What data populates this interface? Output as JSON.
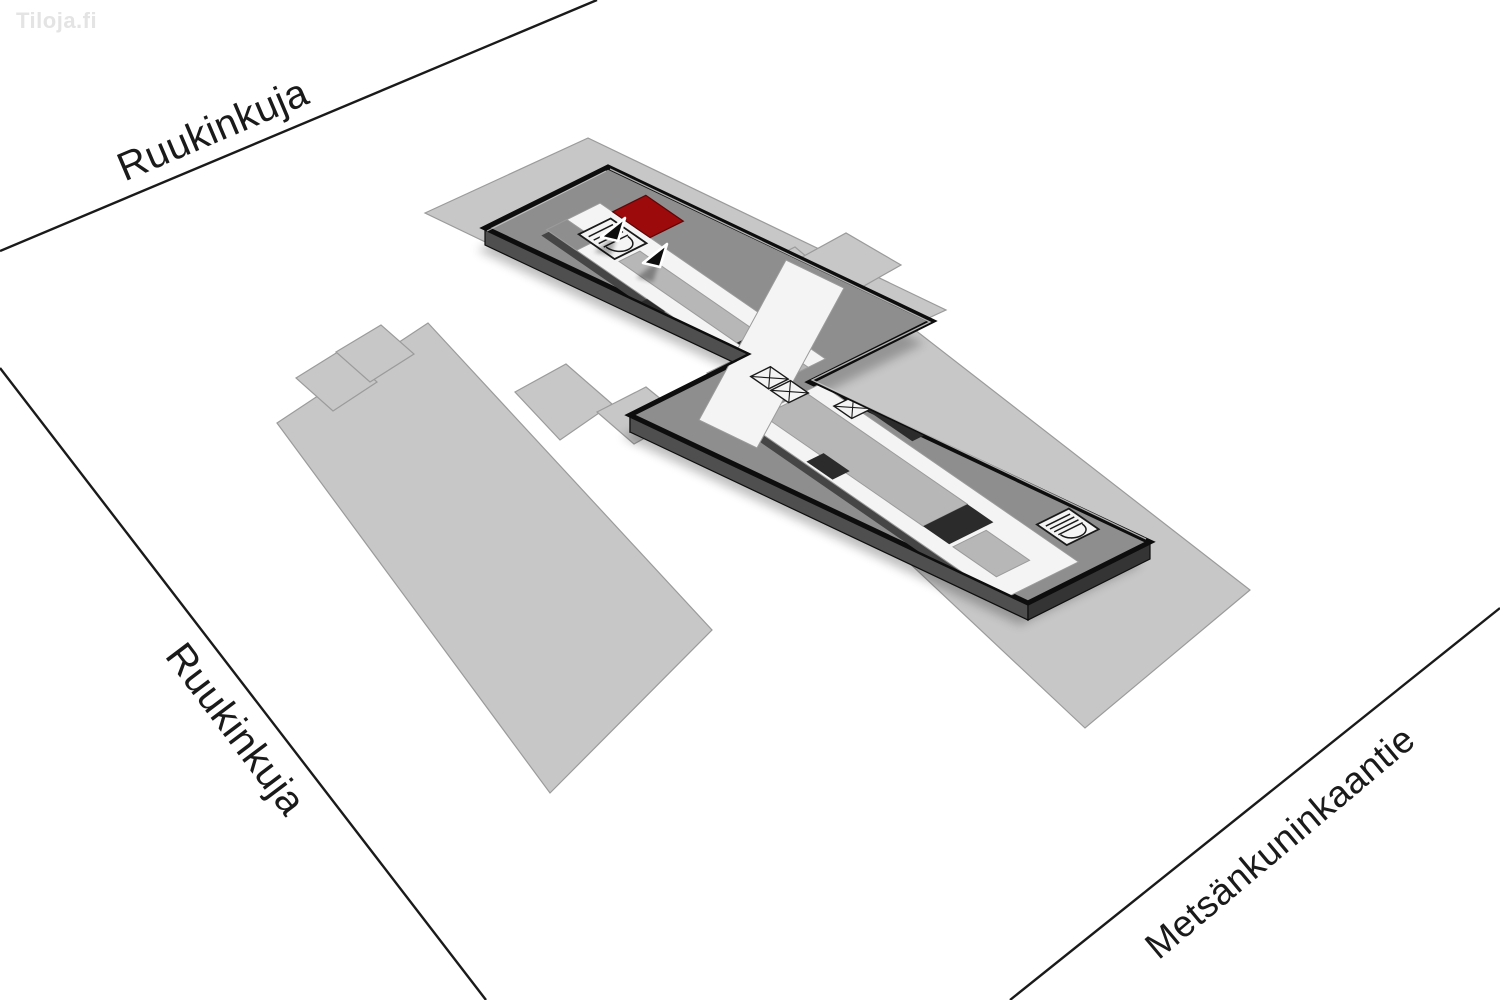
{
  "watermark": {
    "text": "Tiloja.fi"
  },
  "streets": {
    "top": {
      "name": "Ruukinkuja"
    },
    "left": {
      "name": "Ruukinkuja"
    },
    "bottom_right": {
      "name": "Metsänkuninkaantie"
    }
  },
  "map": {
    "highlighted_unit_color": "#9c0a0c",
    "icons": {
      "marker": "location-arrow-icon",
      "elevator": "elevator-icon",
      "stairs": "stairs-icon"
    }
  },
  "colors": {
    "page_bg": "#ffffff",
    "plot": "#c7c7c7",
    "plot_stroke": "#9b9b9b",
    "roof": "#8e8e8e",
    "inner_zone": "#b7b7b7",
    "corridor": "#f4f4f4",
    "corridor_stroke": "#9b9b9b",
    "red": "#9c0a0c",
    "red_stroke": "#5e0505",
    "outline": "#0d0d0d",
    "side_sw": "#4f4f4f",
    "side_se": "#343434",
    "side_w": "#5e5e5e",
    "wall_dark": "#2b2b2b",
    "inner_face": "#454545",
    "highlight_line": "#cfcfcf",
    "marker": "#0d0d0d",
    "street_line": "#1a1a1a"
  }
}
